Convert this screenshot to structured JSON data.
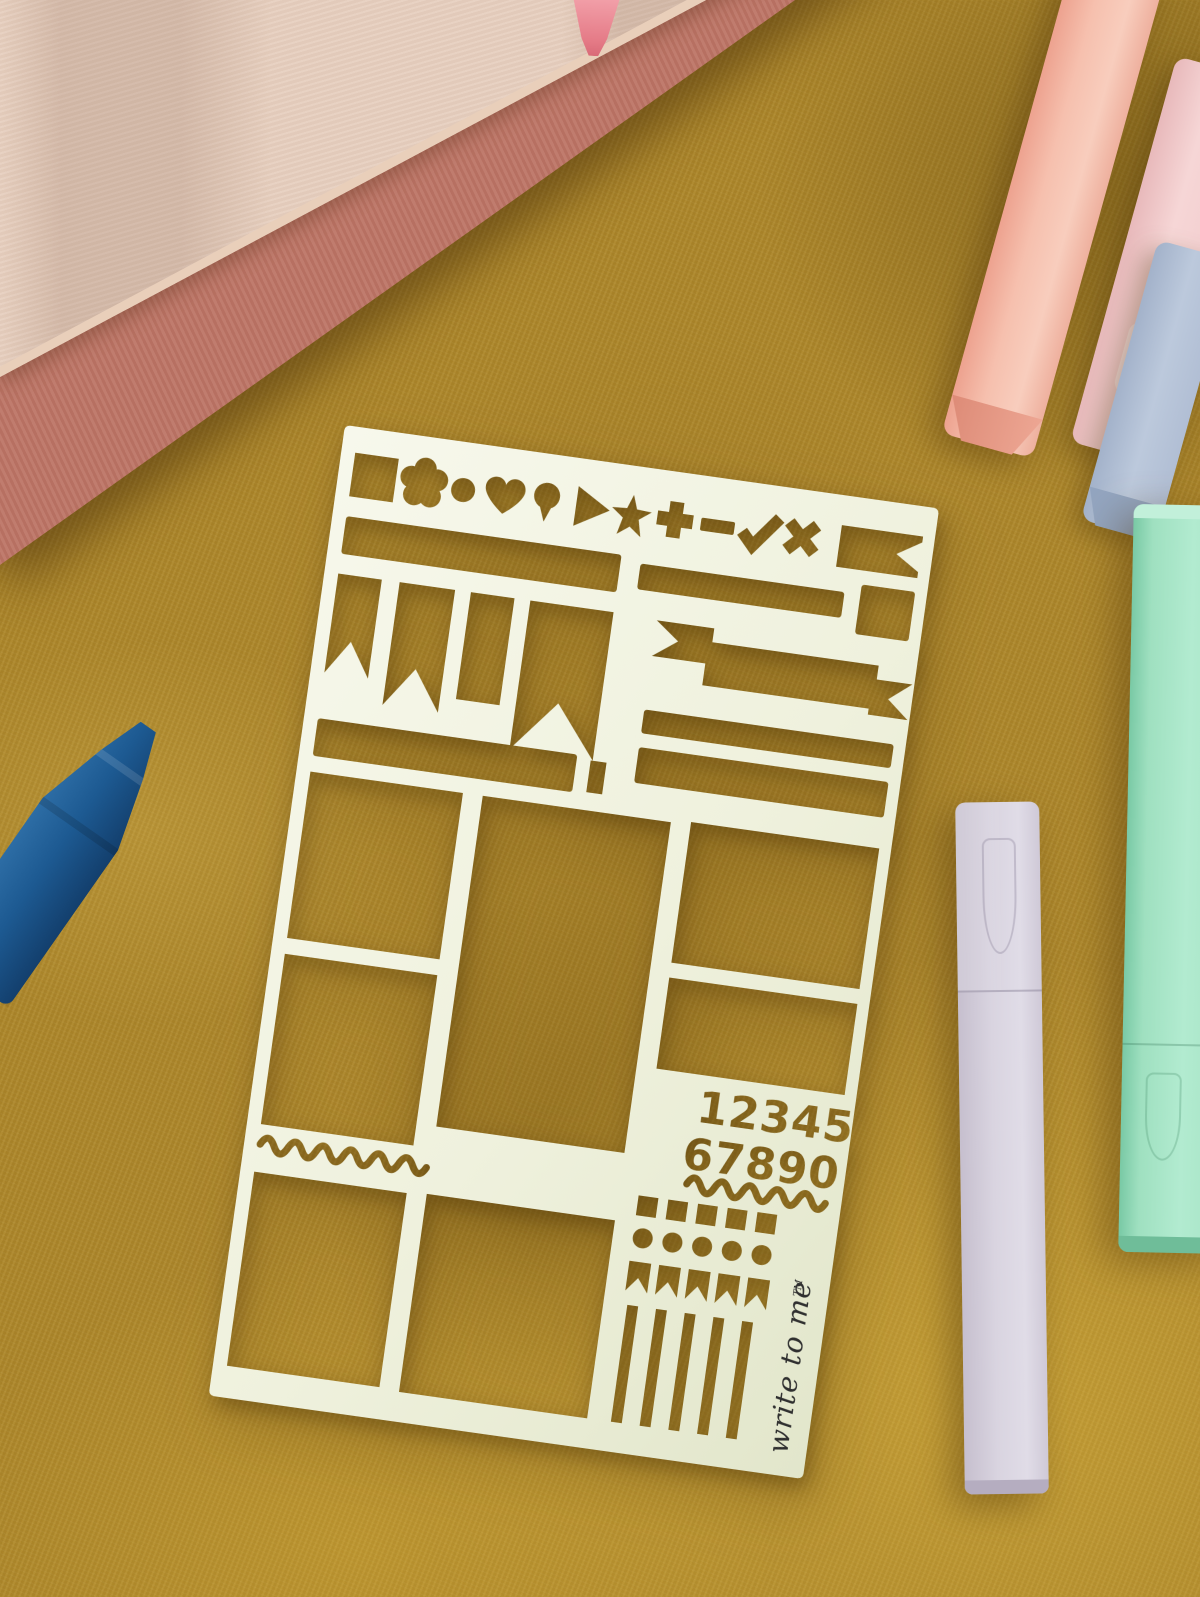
{
  "scene": {
    "type": "flat-lay photograph",
    "description": "Cream journaling stencil sheet lying on mustard velvet fabric, surrounded by pastel pens and a stack of notebooks",
    "fabric_color": "#ac862a"
  },
  "stencil": {
    "sheet_color": "#f0f2df",
    "digits_line1": "12345",
    "digits_line2": "67890",
    "logo_text": "write to me",
    "trademark_symbol": "TM",
    "logo_ink_color": "#2f2f2f",
    "icon_cutouts": [
      "square",
      "flower",
      "dot",
      "heart",
      "balloon",
      "play-triangle",
      "star",
      "plus",
      "dash",
      "checkmark",
      "cross",
      "ribbon-flag"
    ],
    "cutout_groups": [
      "icon strip",
      "header bars",
      "pennant flags",
      "ribbon banner",
      "layout boxes",
      "number digits",
      "squiggle rules",
      "square grid",
      "dot grid",
      "flag grid",
      "stripe rules"
    ]
  },
  "props": {
    "notebook_stack": {
      "cover_color": "#e7d0c0",
      "spine_color": "#bd7566"
    },
    "pink_pen_tip": {
      "color": "#e57b87"
    },
    "pastel_pens": [
      {
        "name": "peach highlighter",
        "color": "#f6c0ae"
      },
      {
        "name": "pink highlighter",
        "color": "#f6d6d6"
      },
      {
        "name": "blue highlighter",
        "color": "#bcc9dc"
      }
    ],
    "mint_pen": {
      "color": "#a5e3c4"
    },
    "lavender_pen": {
      "color": "#d9d4e0"
    },
    "blue_crayon_pen": {
      "color": "#1d5a92"
    }
  }
}
